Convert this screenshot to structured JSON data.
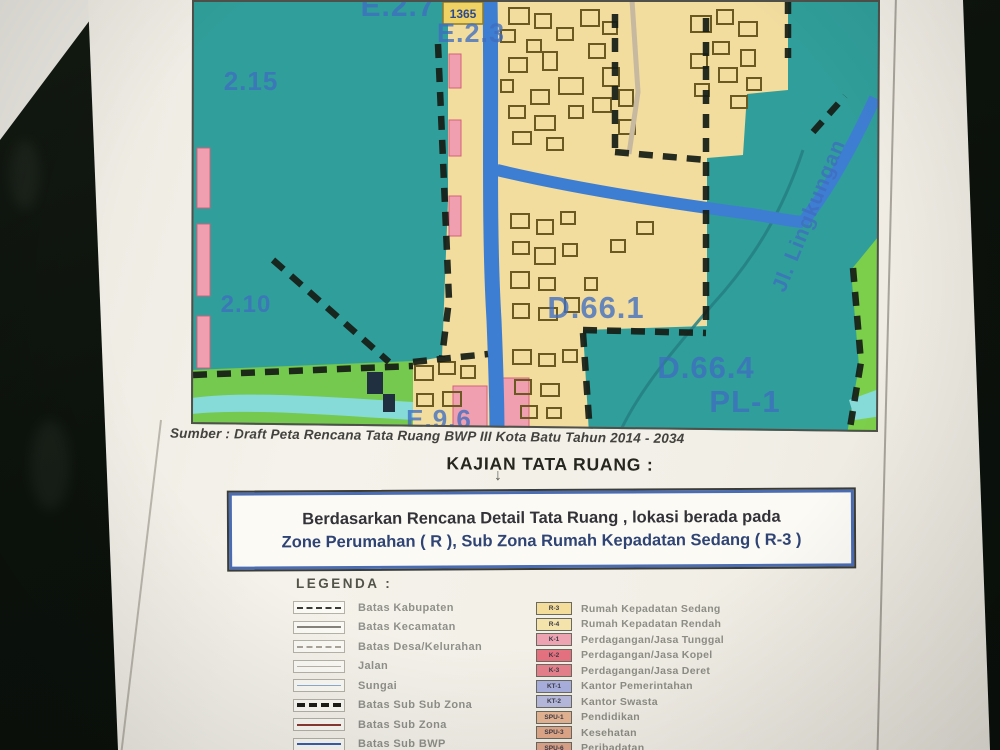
{
  "map": {
    "source_line": "Sumber : Draft Peta Rencana Tata Ruang BWP III Kota Batu Tahun 2014 - 2034",
    "badge_text": "1365",
    "labels": [
      {
        "text": "E.2.7",
        "x": 207,
        "y": 16,
        "size": 30
      },
      {
        "text": "E.2.3",
        "x": 280,
        "y": 42,
        "size": 27
      },
      {
        "text": "2.15",
        "x": 60,
        "y": 90,
        "size": 26
      },
      {
        "text": "2.10",
        "x": 55,
        "y": 312,
        "size": 24
      },
      {
        "text": "D.66.1",
        "x": 405,
        "y": 318,
        "size": 31
      },
      {
        "text": "D.66.4",
        "x": 515,
        "y": 378,
        "size": 31
      },
      {
        "text": "PL-1",
        "x": 554,
        "y": 412,
        "size": 31
      },
      {
        "text": "E.9.6",
        "x": 248,
        "y": 428,
        "size": 26
      },
      {
        "text": "Jl. Lingkungan",
        "x": 624,
        "y": 218,
        "size": 21,
        "rotate": -68
      }
    ],
    "colors": {
      "zone_teal": "#309e9a",
      "zone_yellow": "#f2dc9e",
      "road_blue": "#3e7ed2",
      "green_belt": "#74c94e",
      "river_cyan": "#86dbd8",
      "pink_zone": "#ef9fb0",
      "boundary_dash": "#161d15",
      "label_blue": "#3f6dc0"
    },
    "buildings": [
      [
        318,
        8,
        20,
        16
      ],
      [
        344,
        14,
        16,
        14
      ],
      [
        366,
        28,
        16,
        12
      ],
      [
        390,
        10,
        18,
        16
      ],
      [
        412,
        22,
        14,
        12
      ],
      [
        336,
        40,
        14,
        12
      ],
      [
        398,
        44,
        16,
        14
      ],
      [
        318,
        58,
        18,
        14
      ],
      [
        352,
        52,
        14,
        18
      ],
      [
        368,
        78,
        24,
        16
      ],
      [
        340,
        90,
        18,
        14
      ],
      [
        412,
        68,
        16,
        18
      ],
      [
        318,
        106,
        16,
        12
      ],
      [
        344,
        116,
        20,
        14
      ],
      [
        378,
        106,
        14,
        12
      ],
      [
        402,
        98,
        18,
        14
      ],
      [
        428,
        90,
        14,
        16
      ],
      [
        322,
        132,
        18,
        12
      ],
      [
        356,
        138,
        16,
        12
      ],
      [
        428,
        120,
        16,
        14
      ],
      [
        310,
        30,
        14,
        12
      ],
      [
        310,
        80,
        12,
        12
      ],
      [
        500,
        16,
        20,
        16
      ],
      [
        526,
        10,
        16,
        14
      ],
      [
        548,
        22,
        18,
        14
      ],
      [
        522,
        42,
        16,
        12
      ],
      [
        550,
        50,
        14,
        16
      ],
      [
        500,
        54,
        16,
        14
      ],
      [
        528,
        68,
        18,
        14
      ],
      [
        556,
        78,
        14,
        12
      ],
      [
        504,
        84,
        14,
        12
      ],
      [
        540,
        96,
        16,
        12
      ],
      [
        320,
        214,
        18,
        14
      ],
      [
        346,
        220,
        16,
        14
      ],
      [
        370,
        212,
        14,
        12
      ],
      [
        322,
        242,
        16,
        12
      ],
      [
        344,
        248,
        20,
        16
      ],
      [
        372,
        244,
        14,
        12
      ],
      [
        320,
        272,
        18,
        16
      ],
      [
        348,
        278,
        16,
        12
      ],
      [
        322,
        304,
        16,
        14
      ],
      [
        348,
        308,
        18,
        12
      ],
      [
        374,
        298,
        14,
        14
      ],
      [
        394,
        278,
        12,
        12
      ],
      [
        420,
        240,
        14,
        12
      ],
      [
        446,
        222,
        16,
        12
      ],
      [
        322,
        350,
        18,
        14
      ],
      [
        348,
        354,
        16,
        12
      ],
      [
        372,
        350,
        14,
        12
      ],
      [
        324,
        380,
        16,
        14
      ],
      [
        350,
        384,
        18,
        12
      ],
      [
        330,
        406,
        16,
        12
      ],
      [
        356,
        408,
        14,
        10
      ],
      [
        224,
        366,
        18,
        14
      ],
      [
        248,
        362,
        16,
        12
      ],
      [
        270,
        366,
        14,
        12
      ],
      [
        226,
        394,
        16,
        12
      ],
      [
        252,
        392,
        18,
        14
      ]
    ],
    "pink_patches": [
      [
        258,
        54,
        12,
        34
      ],
      [
        258,
        120,
        12,
        36
      ],
      [
        258,
        196,
        12,
        40
      ],
      [
        262,
        386,
        34,
        46
      ],
      [
        310,
        378,
        28,
        54
      ],
      [
        6,
        148,
        13,
        60
      ],
      [
        6,
        224,
        13,
        72
      ],
      [
        6,
        316,
        13,
        52
      ]
    ],
    "dark_structures": [
      [
        176,
        372,
        16,
        22
      ],
      [
        192,
        394,
        12,
        18
      ]
    ]
  },
  "analysis": {
    "heading": "KAJIAN TATA RUANG :",
    "arrow_glyph": "↓",
    "result_line1": "Berdasarkan Rencana Detail Tata Ruang , lokasi berada pada",
    "result_line2": "Zone Perumahan ( R ), Sub Zona Rumah Kepadatan Sedang ( R-3 )"
  },
  "legend": {
    "title": "LEGENDA :",
    "left_items": [
      {
        "label": "Batas Kabupaten",
        "style": "ls-dashdot"
      },
      {
        "label": "Batas Kecamatan",
        "style": "ls-gray"
      },
      {
        "label": "Batas Desa/Kelurahan",
        "style": "ls-lightdash"
      },
      {
        "label": "Jalan",
        "style": "ls-thin"
      },
      {
        "label": "Sungai",
        "style": "ls-blue"
      },
      {
        "label": "Batas Sub Sub Zona",
        "style": "ls-blackdash"
      },
      {
        "label": "Batas Sub Zona",
        "style": "ls-maroon"
      },
      {
        "label": "Batas Sub BWP",
        "style": "ls-bwp"
      },
      {
        "label": "",
        "style": "ls-maroon"
      }
    ],
    "right_items": [
      {
        "code": "R-3",
        "label": "Rumah Kepadatan Sedang",
        "color": "#f4dd9b"
      },
      {
        "code": "R-4",
        "label": "Rumah Kepadatan Rendah",
        "color": "#f4e3ab"
      },
      {
        "code": "K-1",
        "label": "Perdagangan/Jasa Tunggal",
        "color": "#eda3b2"
      },
      {
        "code": "K-2",
        "label": "Perdagangan/Jasa Kopel",
        "color": "#e4717f"
      },
      {
        "code": "K-3",
        "label": "Perdagangan/Jasa Deret",
        "color": "#e4808c"
      },
      {
        "code": "KT-1",
        "label": "Kantor Pemerintahan",
        "color": "#aab0de"
      },
      {
        "code": "KT-2",
        "label": "Kantor Swasta",
        "color": "#b8badf"
      },
      {
        "code": "SPU-1",
        "label": "Pendidikan",
        "color": "#e7b694"
      },
      {
        "code": "SPU-3",
        "label": "Kesehatan",
        "color": "#e3a98a"
      },
      {
        "code": "SPU-6",
        "label": "Peribadatan",
        "color": "#dfa58c"
      }
    ]
  }
}
